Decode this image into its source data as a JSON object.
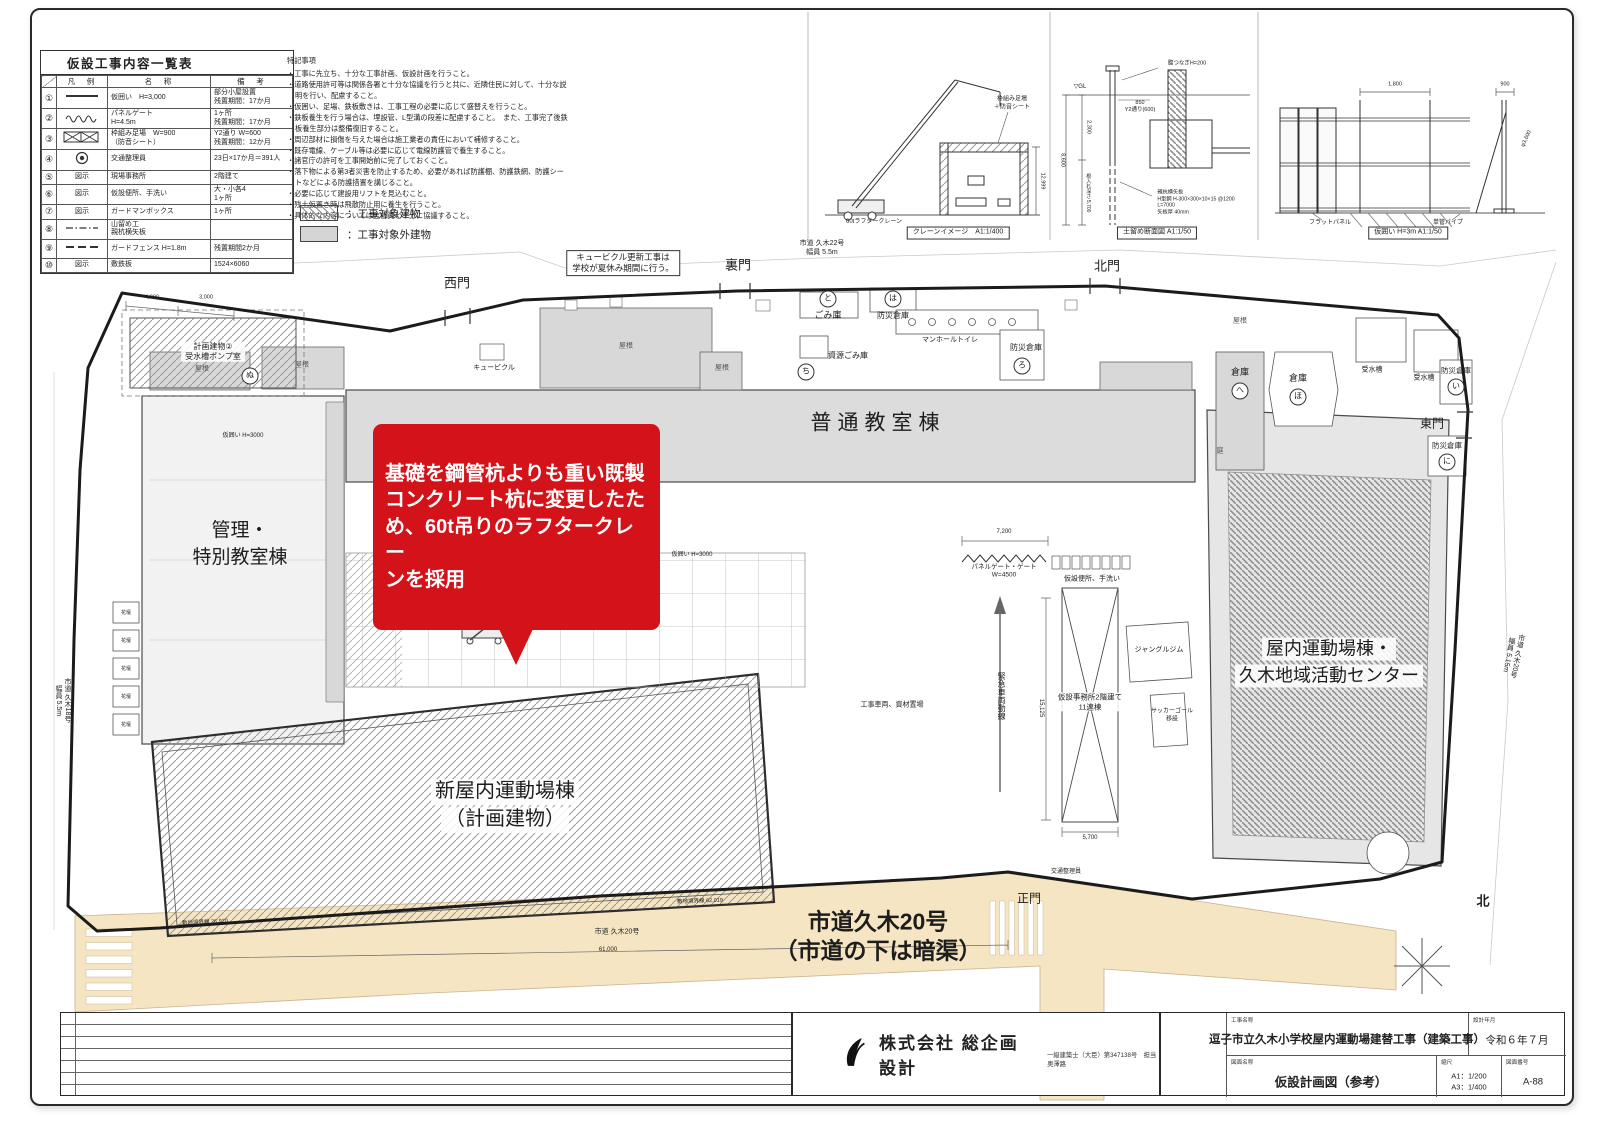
{
  "colors": {
    "callout_red": "#d3121a",
    "road_beige": "#f5e5c2",
    "building_gray": "#d8d8d8",
    "hatch_gray": "#999999",
    "boundary": "#1b1b1b"
  },
  "legend_table": {
    "title": "仮設工事内容一覧表",
    "headers": [
      "凡　例",
      "名　称",
      "備　考"
    ],
    "rows": [
      {
        "no": "①",
        "sym": "line",
        "name": "仮囲い　H=3,000",
        "remark": "部分小屋設置\n残置期間：17か月"
      },
      {
        "no": "②",
        "sym": "wave",
        "name": "パネルゲート\nH=4.5m",
        "remark": "1ヶ所\n残置期間：17か月"
      },
      {
        "no": "③",
        "sym": "xbox",
        "name": "枠組み足場　W=900\n（防音シート）",
        "remark": "Y2通り W=600\n残置期間：12か月"
      },
      {
        "no": "④",
        "sym": "circle",
        "name": "交通整理員",
        "remark": "23日×17か月＝391人"
      },
      {
        "no": "⑤",
        "sym": "text",
        "sym_label": "図示",
        "name": "現場事務所",
        "remark": "2階建て"
      },
      {
        "no": "⑥",
        "sym": "text",
        "sym_label": "図示",
        "name": "仮設便所、手洗い",
        "remark": "大・小各4\n1ヶ所"
      },
      {
        "no": "⑦",
        "sym": "text",
        "sym_label": "図示",
        "name": "ガードマンボックス",
        "remark": "1ヶ所"
      },
      {
        "no": "⑧",
        "sym": "dashdot",
        "name": "山留め工\n親杭横矢板",
        "remark": ""
      },
      {
        "no": "⑨",
        "sym": "dash",
        "name": "ガードフェンス H=1.8m",
        "remark": "残置期間2か月"
      },
      {
        "no": "⑩",
        "sym": "text",
        "sym_label": "図示",
        "name": "敷鉄板",
        "remark": "1524×6060"
      }
    ]
  },
  "notes": {
    "title": "特記事項",
    "items": [
      "工事に先立ち、十分な工事計画、仮設計画を行うこと。",
      "道路使用許可等は関係各署と十分な協議を行うと共に、近隣住民に対して、十分な説明を行い、配慮すること。",
      "仮囲い、足場、鉄板敷きは、工事工程の必要に応じて盛替えを行うこと。",
      "鉄板養生を行う場合は、埋設管、L型溝の段差に配慮すること。　また、工事完了後鉄板養生部分は整備復旧すること。",
      "周辺部材に損傷を与えた場合は施工業者の責任において補修すること。",
      "既存電線、ケーブル等は必要に応じて電線防護管で養生すること。",
      "諸官庁の許可を工事開始前に完了しておくこと。",
      "落下物による第3者災害を防止するため、必要があれば防護棚、防護鉄網、防護シートなどによる防護措置を講じること。",
      "必要に応じて建設用リフトを見込むこと。",
      "残土仮置き時は飛散防止用に養生を行うこと。",
      "具体的な内容については監督員と十分に協議すること。"
    ]
  },
  "hatch_legend": [
    {
      "label": "：工事対象建物"
    },
    {
      "label": "：工事対象外建物"
    }
  ],
  "callout": {
    "text": "基礎を鋼管杭よりも重い既製\nコンクリート杭に変更したた\nめ、60t吊りのラフタークレー\nンを採用",
    "target_label": "60tラフタークレーン"
  },
  "titleblock": {
    "company": "株式会社 総企画設計",
    "license": "一級建築士（大臣）第347138号　担当　奥澤路",
    "project_label": "工事名称",
    "project": "逗子市立久木小学校屋内運動場建替工事（建築工事）",
    "date_label": "設計年月",
    "date": "令和６年７月",
    "drawing_label": "図面名称",
    "drawing": "仮設計画図（参考）",
    "scale_label": "縮尺",
    "scale_a1": "A1：1/200",
    "scale_a3": "A3：1/400",
    "number_label": "図面番号",
    "number": "A-88"
  },
  "site": {
    "labels": [
      {
        "t": "西門",
        "x": 457,
        "y": 284,
        "s": 13,
        "n": "gate-west-label"
      },
      {
        "t": "裏門",
        "x": 738,
        "y": 266,
        "s": 13,
        "n": "gate-back-label"
      },
      {
        "t": "北門",
        "x": 1107,
        "y": 267,
        "s": 13,
        "n": "gate-north-label"
      },
      {
        "t": "東門",
        "x": 1432,
        "y": 424,
        "s": 12,
        "n": "gate-east-label"
      },
      {
        "t": "正門",
        "x": 1029,
        "y": 899,
        "s": 12,
        "n": "gate-main-label"
      },
      {
        "t": "普通教室棟",
        "x": 878,
        "y": 424,
        "s": 21,
        "c": "ls6",
        "n": "building-label"
      },
      {
        "t": "管理・",
        "x": 240,
        "y": 531,
        "s": 19,
        "n": "building-label"
      },
      {
        "t": "特別教室棟",
        "x": 240,
        "y": 558,
        "s": 19,
        "n": "building-label"
      },
      {
        "t": "新屋内運動場棟",
        "x": 505,
        "y": 792,
        "s": 20,
        "c": "wbg",
        "n": "building-label"
      },
      {
        "t": "（計画建物）",
        "x": 505,
        "y": 820,
        "s": 20,
        "c": "wbg",
        "n": "building-label"
      },
      {
        "t": "屋内運動場棟・",
        "x": 1329,
        "y": 649,
        "s": 18,
        "c": "wbg",
        "n": "building-label"
      },
      {
        "t": "久木地域活動センター",
        "x": 1329,
        "y": 676,
        "s": 18,
        "c": "wbg",
        "n": "building-label"
      },
      {
        "t": "市道久木20号",
        "x": 878,
        "y": 922,
        "s": 23,
        "c": "bold",
        "n": "road-label"
      },
      {
        "t": "（市道の下は暗渠）",
        "x": 878,
        "y": 951,
        "s": 23,
        "c": "bold",
        "n": "road-label"
      },
      {
        "t": "60tラフタークレーン",
        "x": 505,
        "y": 593,
        "s": 17,
        "c": "red bold",
        "n": "crane-label"
      },
      {
        "t": "キュービクル更新工事は\n学校が夏休み期間に行う。",
        "x": 623,
        "y": 263,
        "s": 8.5,
        "c": "pre boxed",
        "n": "cubicle-note"
      },
      {
        "t": "キュービクル",
        "x": 494,
        "y": 369,
        "s": 7
      },
      {
        "t": "市道 久木22号\n幅員 5.5m",
        "x": 822,
        "y": 249,
        "s": 7,
        "c": "pre"
      },
      {
        "t": "と",
        "x": 828,
        "y": 299,
        "s": 8,
        "c": "circ"
      },
      {
        "t": "ごみ庫",
        "x": 828,
        "y": 316,
        "s": 9
      },
      {
        "t": "ち",
        "x": 806,
        "y": 372,
        "s": 8,
        "c": "circ"
      },
      {
        "t": "資源ごみ庫",
        "x": 848,
        "y": 356,
        "s": 8
      },
      {
        "t": "は",
        "x": 893,
        "y": 299,
        "s": 8,
        "c": "circ"
      },
      {
        "t": "防災倉庫",
        "x": 893,
        "y": 316,
        "s": 8
      },
      {
        "t": "マンホールトイレ",
        "x": 950,
        "y": 341,
        "s": 7
      },
      {
        "t": "防災倉庫",
        "x": 1026,
        "y": 348,
        "s": 8
      },
      {
        "t": "ろ",
        "x": 1022,
        "y": 366,
        "s": 8,
        "c": "circ"
      },
      {
        "t": "倉庫",
        "x": 1240,
        "y": 373,
        "s": 9
      },
      {
        "t": "へ",
        "x": 1240,
        "y": 391,
        "s": 8,
        "c": "circ"
      },
      {
        "t": "倉庫",
        "x": 1298,
        "y": 379,
        "s": 9
      },
      {
        "t": "ほ",
        "x": 1298,
        "y": 397,
        "s": 8,
        "c": "circ"
      },
      {
        "t": "受水槽",
        "x": 1372,
        "y": 371,
        "s": 7
      },
      {
        "t": "受水槽",
        "x": 1424,
        "y": 379,
        "s": 7
      },
      {
        "t": "防災倉庫",
        "x": 1456,
        "y": 371,
        "s": 7.5
      },
      {
        "t": "い",
        "x": 1456,
        "y": 387,
        "s": 8,
        "c": "circ"
      },
      {
        "t": "防災倉庫",
        "x": 1447,
        "y": 446,
        "s": 7.5
      },
      {
        "t": "に",
        "x": 1447,
        "y": 462,
        "s": 8,
        "c": "circ"
      },
      {
        "t": "ぬ",
        "x": 250,
        "y": 376,
        "s": 8,
        "c": "circ"
      },
      {
        "t": "屋根",
        "x": 202,
        "y": 370,
        "s": 7,
        "c": "dim"
      },
      {
        "t": "屋根",
        "x": 302,
        "y": 366,
        "s": 7,
        "c": "dim"
      },
      {
        "t": "屋根",
        "x": 626,
        "y": 347,
        "s": 7,
        "c": "dim"
      },
      {
        "t": "屋根",
        "x": 722,
        "y": 369,
        "s": 7,
        "c": "dim"
      },
      {
        "t": "屋根",
        "x": 1240,
        "y": 322,
        "s": 7,
        "c": "dim"
      },
      {
        "t": "庭",
        "x": 1220,
        "y": 452,
        "s": 7,
        "c": "dim"
      },
      {
        "t": "ジャングルジム",
        "x": 1159,
        "y": 651,
        "s": 7
      },
      {
        "t": "サッカーゴール\n移設",
        "x": 1172,
        "y": 716,
        "s": 6,
        "c": "pre"
      },
      {
        "t": "仮設事務所2階建て\n11連棟",
        "x": 1090,
        "y": 702,
        "s": 7.5,
        "c": "pre wbg"
      },
      {
        "t": "仮設便所、手洗い",
        "x": 1092,
        "y": 580,
        "s": 7
      },
      {
        "t": "パネルゲート・ゲート\nW=4500",
        "x": 1004,
        "y": 572,
        "s": 6.5,
        "c": "pre"
      },
      {
        "t": "緊急車両動線",
        "x": 1001,
        "y": 696,
        "s": 8,
        "c": "vert"
      },
      {
        "t": "工事車両、資材置場",
        "x": 892,
        "y": 706,
        "s": 7
      },
      {
        "t": "仮囲い H=3000",
        "x": 243,
        "y": 437,
        "s": 6
      },
      {
        "t": "仮囲い H=3000",
        "x": 692,
        "y": 556,
        "s": 6
      },
      {
        "t": "市道 久木18号\n幅員 5.5m",
        "x": 62,
        "y": 700,
        "s": 7,
        "c": "vert pre"
      },
      {
        "t": "市道 久木20号\n幅員 5.15m",
        "x": 1512,
        "y": 655,
        "s": 7,
        "c": "vert pre",
        "r": 12
      },
      {
        "t": "市道 久木20号",
        "x": 617,
        "y": 933,
        "s": 7
      },
      {
        "t": "61,000",
        "x": 608,
        "y": 951,
        "s": 6
      },
      {
        "t": "敷地境界線 62.019",
        "x": 700,
        "y": 902,
        "s": 5.5,
        "r": -2
      },
      {
        "t": "敷地境界線 26.920",
        "x": 205,
        "y": 923,
        "s": 5.5,
        "r": -3
      },
      {
        "t": "交通整理員",
        "x": 1066,
        "y": 873,
        "s": 6
      },
      {
        "t": "北",
        "x": 1483,
        "y": 902,
        "s": 13,
        "c": "bold",
        "n": "north-label"
      },
      {
        "t": "7,200",
        "x": 1004,
        "y": 533,
        "s": 6
      },
      {
        "t": "5,700",
        "x": 1090,
        "y": 839,
        "s": 6
      },
      {
        "t": "15,125",
        "x": 1040,
        "y": 708,
        "s": 6,
        "c": "vert"
      },
      {
        "t": "4,000",
        "x": 152,
        "y": 298,
        "s": 5.5
      },
      {
        "t": "3,000",
        "x": 206,
        "y": 298,
        "s": 5.5
      },
      {
        "t": "計画建物②\n受水槽ポンプ室",
        "x": 213,
        "y": 352,
        "s": 8,
        "c": "pre wbg"
      },
      {
        "t": "花壇",
        "x": 126,
        "y": 613,
        "s": 5
      },
      {
        "t": "花壇",
        "x": 126,
        "y": 641,
        "s": 5
      },
      {
        "t": "花壇",
        "x": 126,
        "y": 669,
        "s": 5
      },
      {
        "t": "花壇",
        "x": 126,
        "y": 697,
        "s": 5
      },
      {
        "t": "花壇",
        "x": 126,
        "y": 725,
        "s": 5
      },
      {
        "t": "60tラフタークレーン",
        "x": 874,
        "y": 223,
        "s": 6
      },
      {
        "t": "クレーンイメージ　A1:1/400",
        "x": 958,
        "y": 233,
        "s": 7,
        "c": "boxed"
      },
      {
        "t": "枠組み足場\n＋防音シート",
        "x": 1012,
        "y": 104,
        "s": 6,
        "c": "pre"
      },
      {
        "t": "12,999",
        "x": 1042,
        "y": 181,
        "s": 5.5,
        "c": "vert"
      },
      {
        "t": "▽GL",
        "x": 1080,
        "y": 88,
        "s": 6
      },
      {
        "t": "腹つなぎH=200",
        "x": 1187,
        "y": 64,
        "s": 5.5
      },
      {
        "t": "850\nY2通り(600)",
        "x": 1140,
        "y": 107,
        "s": 5.5,
        "c": "pre"
      },
      {
        "t": "2,300",
        "x": 1088,
        "y": 127,
        "s": 5.5,
        "c": "vert"
      },
      {
        "t": "8,600",
        "x": 1062,
        "y": 160,
        "s": 5.5,
        "c": "vert"
      },
      {
        "t": "根入れ深さ 5,700",
        "x": 1088,
        "y": 193,
        "s": 5,
        "c": "vert"
      },
      {
        "t": "親杭横矢板\nH型鋼 H-300×300×10×15 @1200\nL=7000\n矢板厚 40mm",
        "x": 1196,
        "y": 203,
        "s": 5.2,
        "c": "pre left"
      },
      {
        "t": "土留め断面図 A1:1/50",
        "x": 1157,
        "y": 233,
        "s": 7,
        "c": "boxed"
      },
      {
        "t": "1,800",
        "x": 1395,
        "y": 85,
        "s": 5.5
      },
      {
        "t": "900",
        "x": 1505,
        "y": 85,
        "s": 5.5
      },
      {
        "t": "φ3,600",
        "x": 1527,
        "y": 139,
        "s": 5.5,
        "r": -65
      },
      {
        "t": "フラットパネル",
        "x": 1330,
        "y": 224,
        "s": 6
      },
      {
        "t": "単管パイプ",
        "x": 1448,
        "y": 224,
        "s": 6
      },
      {
        "t": "仮囲い H=3m A1:1/50",
        "x": 1408,
        "y": 233,
        "s": 7,
        "c": "boxed"
      }
    ]
  }
}
